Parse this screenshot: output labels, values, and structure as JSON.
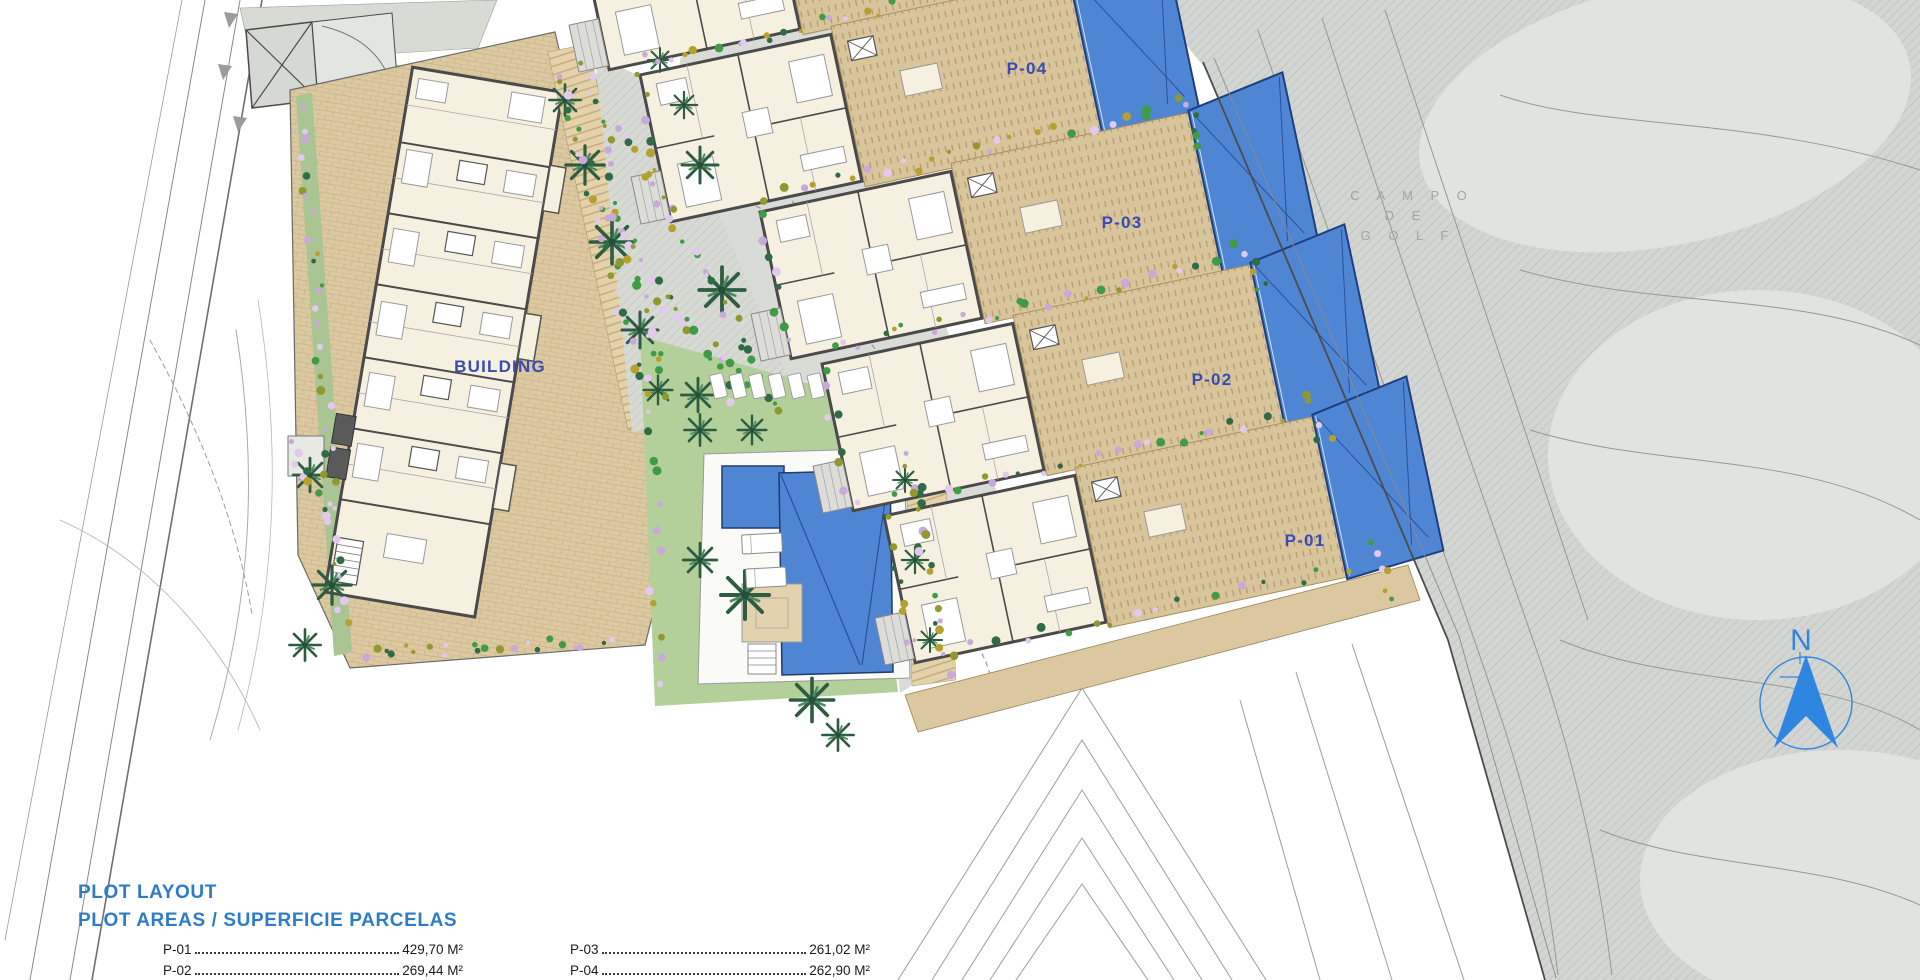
{
  "plan": {
    "building_label": "BUILDING",
    "plots": {
      "p01": "P-01",
      "p02": "P-02",
      "p03": "P-03",
      "p04": "P-04"
    },
    "golf_label_lines": [
      "C A M P O",
      "D E",
      "G O L F"
    ],
    "north_label": "N"
  },
  "legend": {
    "title_line1": "PLOT LAYOUT",
    "title_line2": "PLOT AREAS / SUPERFICIE PARCELAS",
    "rows": [
      {
        "label": "P-01",
        "value": "429,70 M²"
      },
      {
        "label": "P-02",
        "value": "269,44 M²"
      },
      {
        "label": "P-03",
        "value": "261,02 M²"
      },
      {
        "label": "P-04",
        "value": "262,90 M²"
      }
    ]
  },
  "colors": {
    "title_blue": "#2e7cc9",
    "label_blue": "#3a4ab5",
    "north_blue": "#2e86e0",
    "pool_blue": "#4f86d4",
    "terrace_tan": "#d9c59c",
    "lawn_green": "#b3d09b",
    "golf_gray": "#d3d5d3"
  }
}
